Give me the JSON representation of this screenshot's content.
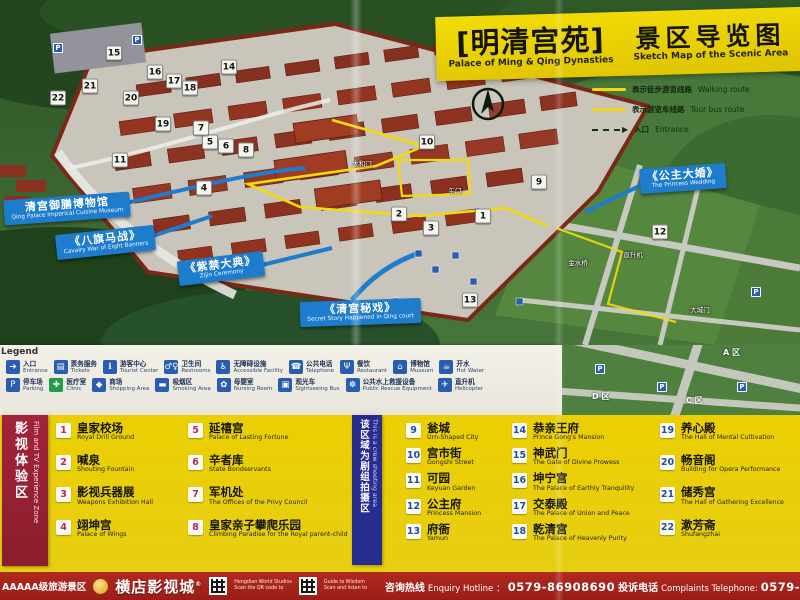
{
  "title_banner": {
    "zh_main": "[明清宫苑]",
    "en_main": "Palace of Ming & Qing Dynasties",
    "zh_sub": "景区导览图",
    "en_sub": "Sketch Map of the Scenic Area"
  },
  "route_legend": {
    "walking": {
      "zh": "表示徒步游览线路",
      "en": "Walking route"
    },
    "bus": {
      "zh": "表示游览车线路",
      "en": "Tour bus route"
    },
    "entrance": {
      "zh": "入口",
      "en": "Entrance"
    }
  },
  "callouts": [
    {
      "zh": "清宫御膳博物馆",
      "en": "Qing Palace Imperical Cuisine Museum"
    },
    {
      "zh": "《八旗马战》",
      "en": "Cavalry War of Eight Banners"
    },
    {
      "zh": "《紫禁大典》",
      "en": "Zijin Ceremony"
    },
    {
      "zh": "《清宫秘戏》",
      "en": "Secret Story Happened in Qing court"
    },
    {
      "zh": "《公主大婚》",
      "en": "The Princess Wedding"
    }
  ],
  "map": {
    "parking_glyph": "P",
    "markers": [
      {
        "n": 1,
        "x": 483,
        "y": 216
      },
      {
        "n": 2,
        "x": 399,
        "y": 214
      },
      {
        "n": 3,
        "x": 431,
        "y": 228
      },
      {
        "n": 4,
        "x": 204,
        "y": 188
      },
      {
        "n": 5,
        "x": 210,
        "y": 142
      },
      {
        "n": 6,
        "x": 226,
        "y": 146
      },
      {
        "n": 7,
        "x": 201,
        "y": 128
      },
      {
        "n": 8,
        "x": 246,
        "y": 150
      },
      {
        "n": 9,
        "x": 539,
        "y": 182
      },
      {
        "n": 10,
        "x": 427,
        "y": 142
      },
      {
        "n": 11,
        "x": 120,
        "y": 160
      },
      {
        "n": 12,
        "x": 660,
        "y": 232
      },
      {
        "n": 13,
        "x": 470,
        "y": 300
      },
      {
        "n": 14,
        "x": 229,
        "y": 67
      },
      {
        "n": 15,
        "x": 114,
        "y": 53
      },
      {
        "n": 16,
        "x": 155,
        "y": 72
      },
      {
        "n": 17,
        "x": 174,
        "y": 81
      },
      {
        "n": 18,
        "x": 190,
        "y": 88
      },
      {
        "n": 19,
        "x": 163,
        "y": 124
      },
      {
        "n": 20,
        "x": 131,
        "y": 98
      },
      {
        "n": 21,
        "x": 90,
        "y": 86
      },
      {
        "n": 22,
        "x": 58,
        "y": 98
      }
    ],
    "labels": [
      {
        "t": "午门",
        "x": 455,
        "y": 190
      },
      {
        "t": "太和门",
        "x": 362,
        "y": 163
      },
      {
        "t": "金水桥",
        "x": 578,
        "y": 262
      },
      {
        "t": "直升机",
        "x": 633,
        "y": 254
      },
      {
        "t": "大城门",
        "x": 700,
        "y": 309
      }
    ],
    "parking": [
      {
        "x": 58,
        "y": 48
      },
      {
        "x": 137,
        "y": 40
      },
      {
        "x": 756,
        "y": 292
      }
    ]
  },
  "map_ext": {
    "labels": [
      {
        "t": "A 区",
        "x": 161,
        "y": 2
      },
      {
        "t": "D 区",
        "x": 30,
        "y": 46
      },
      {
        "t": "C 区",
        "x": 124,
        "y": 50
      }
    ],
    "parking": [
      {
        "x": 100,
        "y": 42
      },
      {
        "x": 180,
        "y": 42
      },
      {
        "x": 38,
        "y": 24
      }
    ]
  },
  "legend_strip": {
    "title": "Legend",
    "rows": [
      [
        {
          "icon": "entrance",
          "glyph": "➔",
          "zh": "入口",
          "en": "Entrance"
        },
        {
          "icon": "tickets",
          "glyph": "▤",
          "zh": "票务服务",
          "en": "Tickets"
        },
        {
          "icon": "tourist-center",
          "glyph": "ℹ",
          "zh": "游客中心",
          "en": "Tourist Center"
        },
        {
          "icon": "restrooms",
          "glyph": "♂♀",
          "zh": "卫生间",
          "en": "Restrooms"
        },
        {
          "icon": "wheelchair",
          "glyph": "♿",
          "zh": "无障碍设施",
          "en": "Accessible Facility"
        },
        {
          "icon": "telephone",
          "glyph": "☎",
          "zh": "公共电话",
          "en": "Telephone"
        },
        {
          "icon": "restaurant",
          "glyph": "Ψ",
          "zh": "餐饮",
          "en": "Restaurant"
        },
        {
          "icon": "museum",
          "glyph": "⌂",
          "zh": "博物馆",
          "en": "Museum"
        },
        {
          "icon": "hot-water",
          "glyph": "☕",
          "zh": "开水",
          "en": "Hot Water"
        }
      ],
      [
        {
          "icon": "parking",
          "glyph": "P",
          "zh": "停车场",
          "en": "Parking"
        },
        {
          "icon": "clinic",
          "glyph": "✚",
          "zh": "医疗室",
          "en": "Clinic",
          "style": "green"
        },
        {
          "icon": "shopping-bag",
          "glyph": "◆",
          "zh": "商场",
          "en": "Shopping Area"
        },
        {
          "icon": "cigarette",
          "glyph": "▬",
          "zh": "吸烟区",
          "en": "Smoking Area"
        },
        {
          "icon": "nursing",
          "glyph": "✿",
          "zh": "母婴室",
          "en": "Nursing Room"
        },
        {
          "icon": "sightseeing-bus",
          "glyph": "▣",
          "zh": "观光车",
          "en": "Sightseeing Bus"
        },
        {
          "icon": "lifebuoy",
          "glyph": "☸",
          "zh": "公共水上救援设备",
          "en": "Public Rescue Equipment"
        },
        {
          "icon": "helicopter",
          "glyph": "✈",
          "zh": "直升机",
          "en": "Helicopter"
        }
      ]
    ]
  },
  "zones": {
    "film": {
      "zh": "影视体验区",
      "en": "Film and TV Experience Zone"
    },
    "crew": {
      "zh": "该区域为剧组拍摄区",
      "en": "This is a crew shooting area"
    }
  },
  "poi_columns": [
    {
      "group": "film",
      "cls": "four",
      "items": [
        {
          "n": 1,
          "zh": "皇家校场",
          "en": "Royal Drill Ground"
        },
        {
          "n": 2,
          "zh": "喊泉",
          "en": "Shouting Fountain"
        },
        {
          "n": 3,
          "zh": "影视兵器展",
          "en": "Weapons Exhibition Hall"
        },
        {
          "n": 4,
          "zh": "翊坤宫",
          "en": "Palace of Wings"
        }
      ]
    },
    {
      "group": "film",
      "cls": "four",
      "items": [
        {
          "n": 5,
          "zh": "延禧宫",
          "en": "Palace of Lasting Fortune"
        },
        {
          "n": 6,
          "zh": "辛者库",
          "en": "State Bondservants"
        },
        {
          "n": 7,
          "zh": "军机处",
          "en": "The Offices of the Privy Council"
        },
        {
          "n": 8,
          "zh": "皇家亲子攀爬乐园",
          "en": "Climbing Paradise for the Royal parent-child"
        }
      ]
    },
    {
      "group": "palace",
      "cls": "five",
      "items": [
        {
          "n": 9,
          "zh": "瓮城",
          "en": "Urn-Shaped City"
        },
        {
          "n": 10,
          "zh": "宫市街",
          "en": "Gongshi Street"
        },
        {
          "n": 11,
          "zh": "可园",
          "en": "Keyuan Garden"
        },
        {
          "n": 12,
          "zh": "公主府",
          "en": "Princess Mansion"
        },
        {
          "n": 13,
          "zh": "府衙",
          "en": "Yamun"
        }
      ]
    },
    {
      "group": "palace",
      "cls": "five",
      "items": [
        {
          "n": 14,
          "zh": "恭亲王府",
          "en": "Prince Gong's Mansion"
        },
        {
          "n": 15,
          "zh": "神武门",
          "en": "The Gate of Divine Prowess"
        },
        {
          "n": 16,
          "zh": "坤宁宫",
          "en": "The Palace of Earthly Tranquility"
        },
        {
          "n": 17,
          "zh": "交泰殿",
          "en": "The Palace of Union and Peace"
        },
        {
          "n": 18,
          "zh": "乾清宫",
          "en": "The Palace of Heavenly Purity"
        }
      ]
    },
    {
      "group": "palace",
      "cls": "four",
      "items": [
        {
          "n": 19,
          "zh": "养心殿",
          "en": "The Hall of Mental Cultivation"
        },
        {
          "n": 20,
          "zh": "畅音阁",
          "en": "Building for Opera Performance"
        },
        {
          "n": 21,
          "zh": "储秀宫",
          "en": "The Hall of Gathering Excellence"
        },
        {
          "n": 22,
          "zh": "漱芳斋",
          "en": "Shufangzhai"
        }
      ]
    }
  ],
  "footer": {
    "rating": "AAAAA级旅游景区",
    "brand": "横店影视城",
    "reg": "®",
    "qr_notes": [
      {
        "l1": "Hengdian World Studios",
        "l2": "Scan the QR code to"
      },
      {
        "l1": "Guide to Wisdom",
        "l2": "Scan and listen to"
      }
    ],
    "hotline_zh": "咨询热线",
    "hotline_en": "Enquiry Hotline",
    "hotline_sep": "：",
    "hotline_num": "0579-86908690",
    "complaints_zh": "投诉电话",
    "complaints_en": "Complaints Telephone:",
    "complaints_num": "0579-"
  },
  "colors": {
    "banner_yellow": "#f2dc06",
    "callout_blue": "#1d7ccc",
    "footer_red": "#a5231d",
    "badge_film": "#c02458",
    "badge_palace": "#1f4f9e"
  }
}
